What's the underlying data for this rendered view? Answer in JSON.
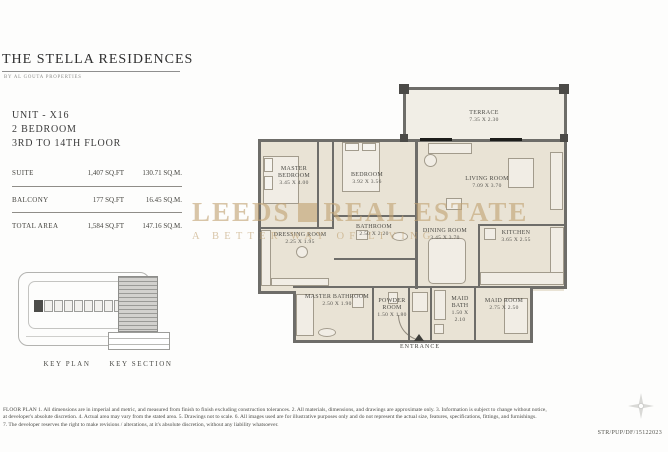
{
  "header": {
    "title": "THE STELLA RESIDENCES",
    "subtitle": "BY AL GOUTA PROPERTIES"
  },
  "unit": {
    "line1": "UNIT - X16",
    "line2": "2 BEDROOM",
    "line3": "3RD TO 14TH FLOOR"
  },
  "area_table": {
    "rows": [
      {
        "label": "SUITE",
        "sqft": "1,407",
        "sqft_unit": "SQ.FT",
        "sqm": "130.71",
        "sqm_unit": "SQ.M."
      },
      {
        "label": "BALCONY",
        "sqft": "177",
        "sqft_unit": "SQ.FT",
        "sqm": "16.45",
        "sqm_unit": "SQ.M."
      },
      {
        "label": "TOTAL AREA",
        "sqft": "1,584",
        "sqft_unit": "SQ.FT",
        "sqm": "147.16",
        "sqm_unit": "SQ.M."
      }
    ]
  },
  "key_drawings": {
    "key_plan_label": "KEY PLAN",
    "key_section_label": "KEY SECTION"
  },
  "floor_plan": {
    "rooms": [
      {
        "name": "TERRACE",
        "dims": "7.35 X 2.30"
      },
      {
        "name": "MASTER BEDROOM",
        "dims": "3.45 X 4.00"
      },
      {
        "name": "BEDROOM",
        "dims": "3.92 X 3.56"
      },
      {
        "name": "LIVING ROOM",
        "dims": "7.09 X 3.70"
      },
      {
        "name": "DRESSING ROOM",
        "dims": "2.25 X 1.95"
      },
      {
        "name": "BATHROOM",
        "dims": "2.50 X 2.20"
      },
      {
        "name": "DINING ROOM",
        "dims": "3.45 X 3.70"
      },
      {
        "name": "KITCHEN",
        "dims": "3.65 X 2.55"
      },
      {
        "name": "MASTER BATHROOM",
        "dims": "2.50 X 1.90"
      },
      {
        "name": "POWDER ROOM",
        "dims": "1.50 X 1.80"
      },
      {
        "name": "MAID BATH",
        "dims": "1.50 X 2.10"
      },
      {
        "name": "MAID ROOM",
        "dims": "2.75 X 2.50"
      }
    ],
    "entrance_label": "ENTRANCE"
  },
  "watermark": {
    "line1a": "LEEDS",
    "line1b": "REAL ESTATE",
    "line2": "A BETTER WAY OF LIVING",
    "color": "#c2a374"
  },
  "footer": {
    "lines": [
      "FLOOR PLAN 1. All dimensions are in imperial and metric, and measured from finish to finish excluding construction tolerances. 2. All materials, dimensions, and drawings are approximate only. 3. Information is subject to change without notice,",
      "at developer's absolute discretion. 4. Actual area may vary from the stated area. 5. Drawings not to scale. 6. All images used are for illustrative purposes only and do not represent the actual size, features, specifications, fittings, and furnishings.",
      "7. The developer reserves the right to make revisions / alterations, at it's absolute discretion, without any liability whatsoever."
    ],
    "ref": "STR/PUP/DF/15122023"
  },
  "colors": {
    "wall": "#6e6d69",
    "floor": "#e9e3d5",
    "terrace_floor": "#f1eee6",
    "watermark": "#c2a374"
  }
}
